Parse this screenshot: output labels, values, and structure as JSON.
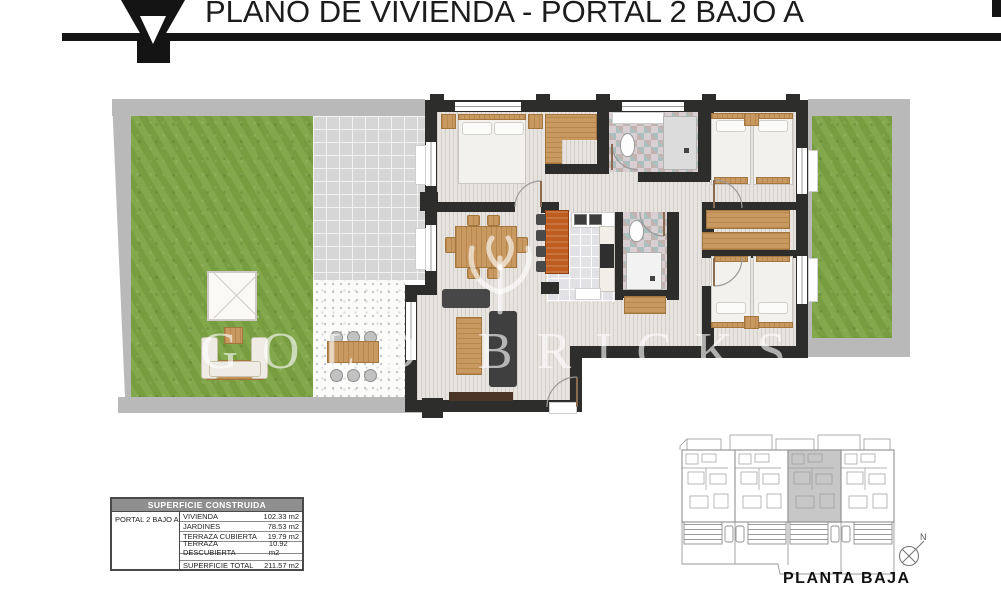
{
  "header": {
    "title": "PLANO DE VIVIENDA - PORTAL 2 BAJO A"
  },
  "watermark": {
    "brand": "GOLD BRICKS"
  },
  "area_table": {
    "title": "SUPERFICIE CONSTRUIDA",
    "unit": "PORTAL 2 BAJO A",
    "rows": [
      {
        "label": "VIVIENDA",
        "value": "102.33 m2"
      },
      {
        "label": "JARDINES",
        "value": "78.53 m2"
      },
      {
        "label": "TERRAZA CUBIERTA",
        "value": "19.79 m2"
      },
      {
        "label": "TERRAZA DESCUBIERTA",
        "value": "10.92 m2"
      }
    ],
    "total": {
      "label": "SUPERFICIE TOTAL",
      "value": "211.57 m2"
    }
  },
  "site_plan": {
    "caption": "PLANTA BAJA",
    "compass_north": "N"
  },
  "colors": {
    "wall_dark": "#2d2d2b",
    "garden_green": "#7ca343",
    "terrace_tile_gray": "#d6d6d6",
    "wood_accent": "#c89a61",
    "kitchen_bar_orange": "#bf5d20",
    "table_header_gray": "#8f8f8f"
  }
}
